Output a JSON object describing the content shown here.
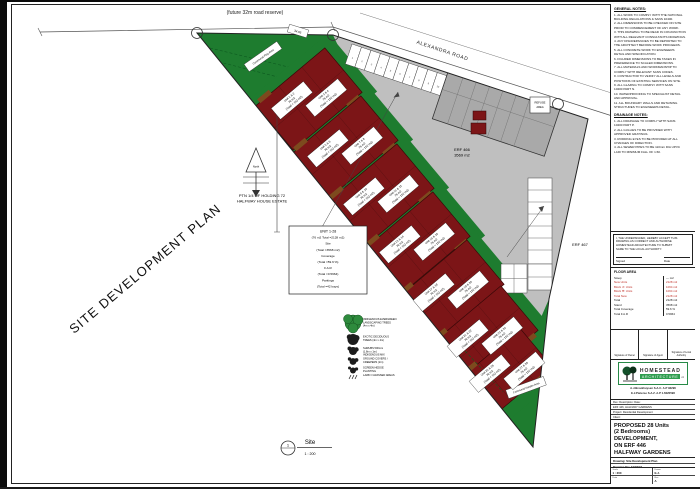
{
  "plan": {
    "labels": {
      "road_reserve": "(future 32m road reserve)",
      "road": "ALEXANDRA ROAD",
      "dim_chip": "34.95",
      "holding1": "PTN 1/4 OF HOLDING 72",
      "holding2": "HALFWAY HOUSE ESTATE",
      "erf1": "ERF 466",
      "erf2": "3569 m2",
      "erf_neighbor": "ERF 467",
      "refuse1": "REFUSE",
      "refuse2": "AREA",
      "north": "North",
      "site_title": "SITE DEVELOPMENT PLAN",
      "communal_top": "Communal Play Area",
      "communal_bottom": "Communal Garden Area"
    },
    "marker": {
      "number": "1",
      "title": "Site",
      "scale": "1 : 200"
    },
    "info_box": {
      "lines": [
        "UNIT 1-28",
        "(76 m2 Total =2128 m2)",
        "Site",
        "(Total =3568 m2)",
        "Coverage",
        "(Total =59.6 %)",
        "F.A.R",
        "(Total =0.5964)",
        "Parkings",
        "(Total =42 bays)"
      ]
    },
    "unit_area": "76 m2",
    "unit_total": "(Total = 152 m2)",
    "buildings": [
      {
        "chips": [
          "Unit 1 & 2",
          "Unit 3 & 4"
        ]
      },
      {
        "chips": [
          "Unit 5 & 6",
          "Unit 7 & 8"
        ]
      },
      {
        "chips": [
          "Unit 9 & 10",
          "Unit 11 & 12"
        ]
      },
      {
        "chips": [
          "Unit 13 & 14",
          "Unit 15 & 16"
        ]
      },
      {
        "chips": [
          "Unit 17 & 18",
          "Unit 19 & 20"
        ]
      },
      {
        "chips": [
          "Unit 21 & 22",
          "Unit 23 & 24"
        ]
      },
      {
        "chips": [
          "Unit 25 & 26",
          "Unit 27 & 28"
        ]
      }
    ],
    "parking": {
      "top_bays": 12,
      "right_bays": 6,
      "lower_bays": 2,
      "visitor_bays": 4
    },
    "legend": {
      "items": [
        {
          "symbol": "tree-green",
          "lines": [
            "INDIGENOUS EVERGREEN",
            "LANDSCAPING TREES",
            "(4m x 4m)"
          ]
        },
        {
          "symbol": "tree-deciduous",
          "lines": [
            "EXOTIC DECIDUOUS",
            "TREES (4m x 4m)"
          ]
        },
        {
          "symbol": "shrub",
          "lines": [
            "SHRUBS 500mm",
            "(1.8m x 1m)",
            "INDIGENOUS MIX"
          ]
        },
        {
          "symbol": "groundcover",
          "lines": [
            "GROUND COVERS /",
            "CREEPERS (2m)"
          ]
        },
        {
          "symbol": "hedge",
          "lines": [
            "SCREEN HEDGE",
            "PLANTING"
          ]
        },
        {
          "symbol": "lawn",
          "lines": [
            "LAWN / GRASSED AREAS"
          ]
        }
      ]
    }
  },
  "sidebar": {
    "general_notes": {
      "heading": "GENERAL NOTES:",
      "lines": [
        "1. ALL WORK TO COMPLY WITH THE NATIONAL",
        "BUILDING REGULATIONS & SANS 10400.",
        "2. ALL DIMENSIONS TO BE CHECKED ON SITE",
        "PRIOR TO COMMENCEMENT OF ANY WORK.",
        "3. THIS DRAWING TO BE READ IN CONJUNCTION",
        "WITH ALL RELEVANT CONSULTANTS DRAWINGS.",
        "4. ANY DISCREPANCIES TO BE REPORTED TO",
        "THE ARCHITECT BEFORE WORK PROCEEDS.",
        "5. ALL CONCRETE WORK TO ENGINEERS",
        "DETAIL AND SPECIFICATION.",
        "6. FIGURED DIMENSIONS TO BE TAKEN IN",
        "PREFERENCE TO SCALED DIMENSIONS.",
        "7. ALL MATERIALS AND WORKMANSHIP TO",
        "COMPLY WITH RELEVANT SANS CODES.",
        "8. CONTRACTOR TO VERIFY ALL LEVELS AND",
        "POSITIONS OF EXISTING SERVICES ON SITE.",
        "9. ALL GLAZING TO COMPLY WITH SANS",
        "10400 PART N.",
        "10. WATERPROOFING TO SPECIALIST DETAIL",
        "AND APPROVAL.",
        "11. ALL BOUNDARY WALLS AND RETAINING",
        "STRUCTURES TO ENGINEERS DETAIL."
      ]
    },
    "drainage_notes": {
      "heading": "DRAINAGE NOTES:",
      "lines": [
        "1. ALL DRAINAGE TO COMPLY WITH SANS",
        "10400 PART P.",
        "2. ALL GULLIES TO BE PROVIDED WITH",
        "APPROVED GRATINGS.",
        "3. RODDING EYES TO BE PROVIDED AT ALL",
        "CHANGES OF DIRECTION.",
        "4. ALL SEWER PIPES TO BE 110mm DIA UPVC",
        "LAID TO MINIMUM FALL OF 1:60."
      ]
    },
    "declaration": {
      "lines": [
        "I, THE UNDERSIGNED, HEREBY ACCEPT THIS",
        "DRAWING AS CORRECT AND AUTHORISE",
        "HOMESTEAD ARCHITECTURE TO SUBMIT",
        "SAME TO THE LOCAL AUTHORITY."
      ],
      "signed_label": "Signed",
      "date_label": "Date"
    },
    "floor_area": {
      "heading": "FLOOR AREA",
      "rows": [
        {
          "label": "Stoep",
          "value": "—  m2",
          "red": false
        },
        {
          "label": "New Units",
          "value": "2128 m2",
          "red": true
        },
        {
          "label": "Block 'A' Units",
          "value": "1064 m2",
          "red": true
        },
        {
          "label": "Block 'B' Units",
          "value": "1064 m2",
          "red": true
        },
        {
          "label": "Total New",
          "value": "2128 m2",
          "red": true
        },
        {
          "label": "Total",
          "value": "2128 m2",
          "red": false
        },
        {
          "label": "Stand",
          "value": "3568 m2",
          "red": false
        },
        {
          "label": "Total Coverage",
          "value": "59.6 %",
          "red": false
        },
        {
          "label": "Total F.A.R",
          "value": "0.5964",
          "red": false
        }
      ]
    },
    "signatures": [
      "Signature of Owner",
      "Signature of Agent",
      "Signature of Local Authority"
    ],
    "logo": {
      "name": "HOMESTEAD",
      "sub": "ARCHITECTURE",
      "cc": "cc"
    },
    "practitioners": [
      "A.J.Broekhuysen  S.A.C. A.P 92296",
      "E.J.Pieterse  S.A.Z. A.P 1.6020596"
    ],
    "info_rows": [
      "Rev:   Description:   Date:",
      "ERF 446, HALFWAY GARDENS",
      "Project: Residential Development",
      "Client:"
    ],
    "title_block": {
      "lines": [
        "PROPOSED 28 Units",
        "(2 Bedrooms)",
        "DEVELOPMENT,",
        "ON ERF 446",
        "HALFWAY GARDENS"
      ],
      "classification": "(Occupation classification = __ )"
    },
    "drawing_rows": [
      "Drawing: Site Development Plan",
      "Drawing No: 12/02/24"
    ],
    "meta": [
      {
        "label": "Scale",
        "value": "1 : 200"
      },
      {
        "label": "Drawn",
        "value": "E.J."
      },
      {
        "label": "Date",
        "value": ""
      },
      {
        "label": "Rev",
        "value": "A"
      }
    ]
  },
  "colors": {
    "site_green": "#1e7c2f",
    "paving_gray": "#bfbfbf",
    "lot_gray": "#a9a9a9",
    "building_red": "#7c1517",
    "timber_brown": "#7d4a1e",
    "logo_green": "#2f9e4f",
    "table_red": "#c03028"
  }
}
